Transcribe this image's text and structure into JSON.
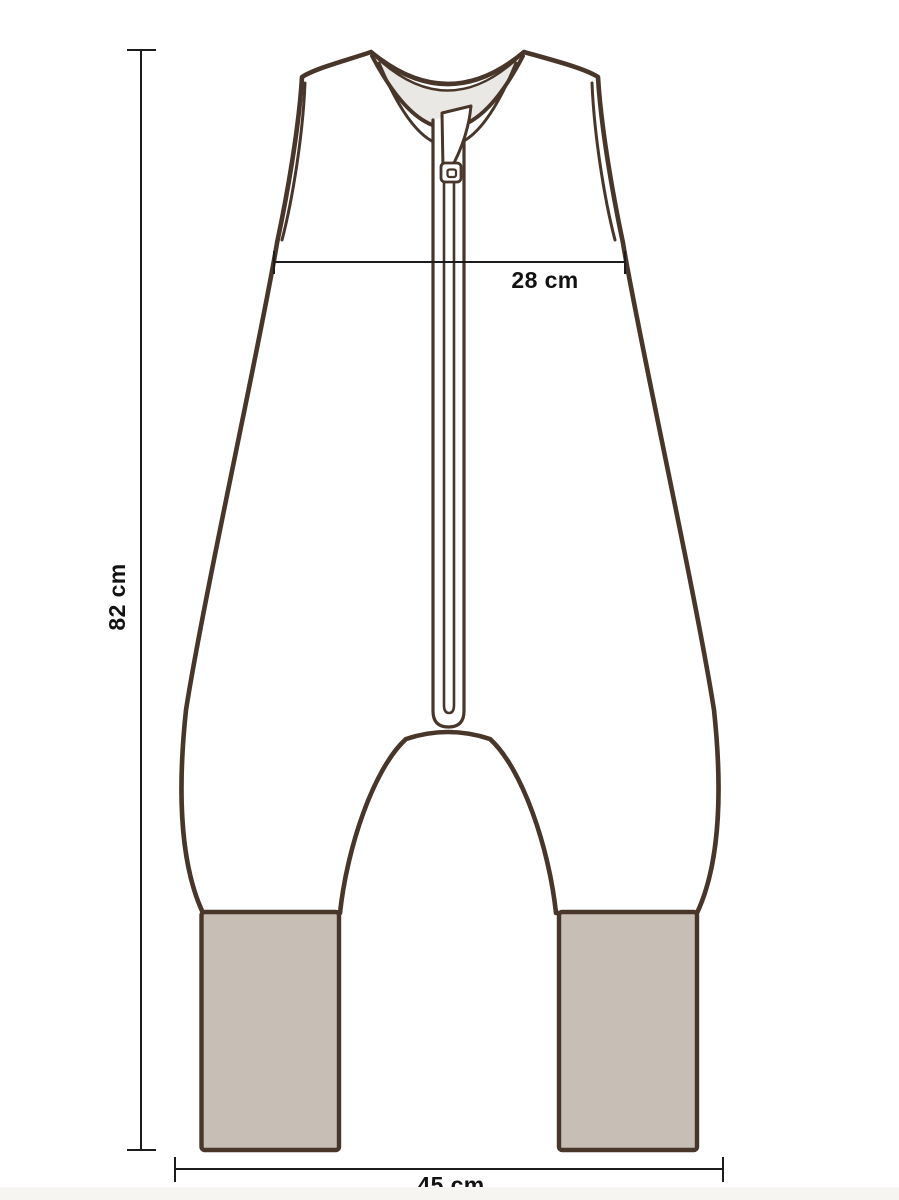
{
  "diagram": {
    "measurements": {
      "chest_width": "28 cm",
      "total_height": "82 cm",
      "bottom_width": "45 cm"
    },
    "colors": {
      "outline": "#48362a",
      "cuff_fill": "#c7beb5",
      "inner_panel": "#e9e8e4",
      "dimension_line": "#1c1c1c",
      "label_text": "#121212",
      "background": "#ffffff"
    }
  }
}
